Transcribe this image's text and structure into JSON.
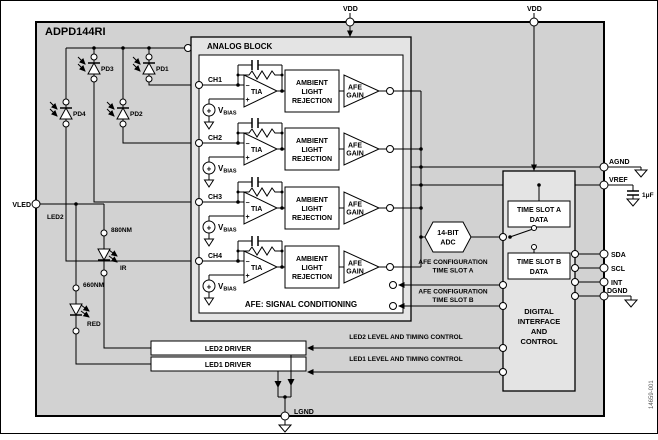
{
  "figure": {
    "part_number": "ADPD144RI",
    "code": "14659-001"
  },
  "pins": {
    "vdd1": "VDD",
    "vdd2": "VDD",
    "vled": "VLED",
    "lgnd": "LGND",
    "agnd": "AGND",
    "vref": "VREF",
    "sda": "SDA",
    "scl": "SCL",
    "int": "INT",
    "dgnd": "DGND",
    "vref_cap": "1μF"
  },
  "photodiodes": {
    "pd1": "PD1",
    "pd2": "PD2",
    "pd3": "PD3",
    "pd4": "PD4"
  },
  "leds": {
    "ir_nm": "880NM",
    "ir_name": "IR",
    "red_nm": "660NM",
    "red_name": "RED",
    "wire_label": "LED2"
  },
  "analog": {
    "title": "ANALOG BLOCK",
    "footer": "AFE: SIGNAL CONDITIONING",
    "ch1": "CH1",
    "ch2": "CH2",
    "ch3": "CH3",
    "ch4": "CH4",
    "tia": "TIA",
    "minus": "−",
    "plus": "+",
    "vbias_main": "V",
    "vbias_sub": "BIAS",
    "alr1": "AMBIENT",
    "alr2": "LIGHT",
    "alr3": "REJECTION",
    "gain1": "AFE",
    "gain2": "GAIN"
  },
  "adc": {
    "line1": "14-BIT",
    "line2": "ADC"
  },
  "digital": {
    "tsa1": "TIME SLOT A",
    "tsa2": "DATA",
    "tsb1": "TIME SLOT B",
    "tsb2": "DATA",
    "d1": "DIGITAL",
    "d2": "INTERFACE",
    "d3": "AND",
    "d4": "CONTROL"
  },
  "config": {
    "a1": "AFE CONFIGURATION",
    "a2": "TIME SLOT A",
    "b1": "AFE CONFIGURATION",
    "b2": "TIME SLOT B"
  },
  "drivers": {
    "led2": "LED2 DRIVER",
    "led1": "LED1 DRIVER",
    "ctrl2": "LED2 LEVEL AND TIMING CONTROL",
    "ctrl1": "LED1 LEVEL AND TIMING CONTROL"
  },
  "colors": {
    "chip_fill": "#d2d2d2",
    "block_fill": "#e4e4e4",
    "box_fill": "#ffffff",
    "line": "#000000"
  }
}
